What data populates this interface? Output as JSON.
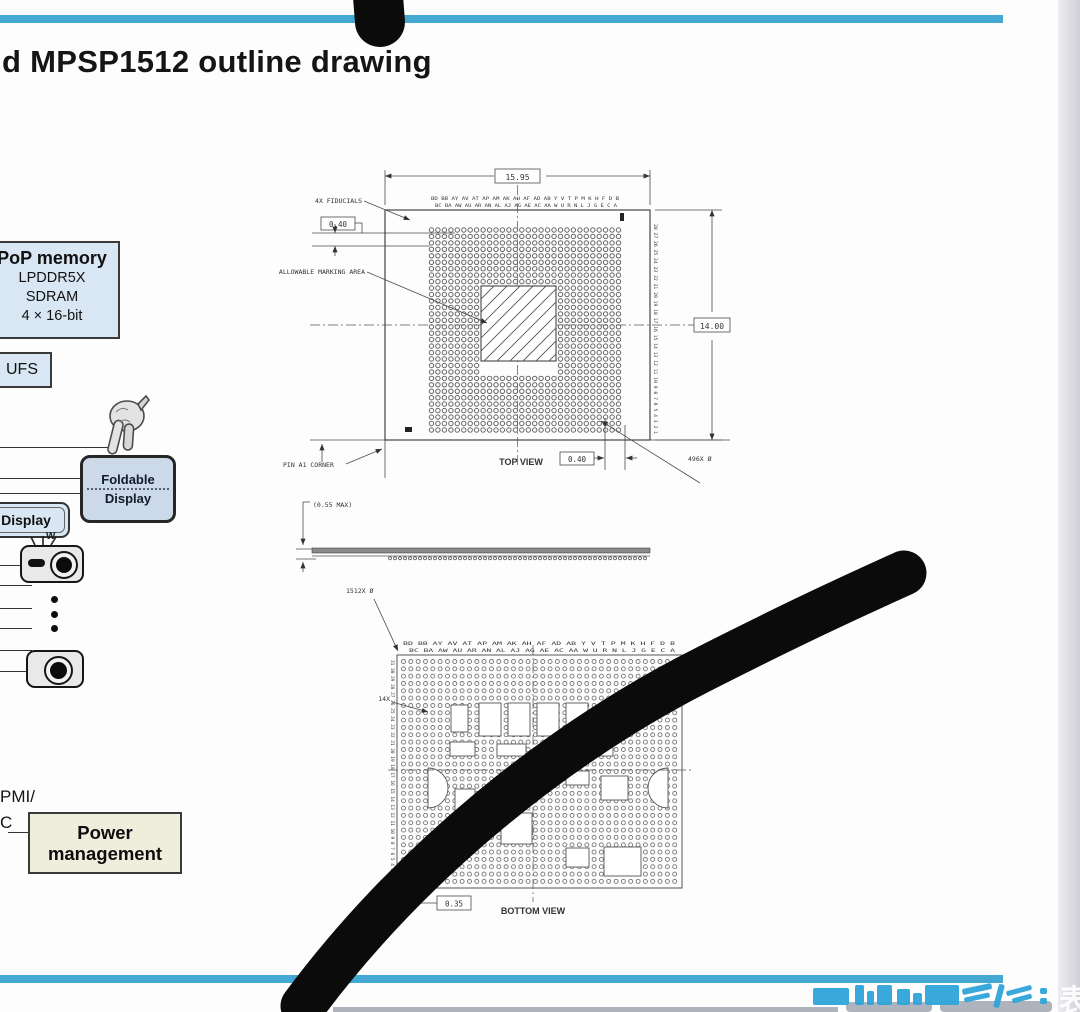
{
  "title": "d MPSP1512 outline drawing",
  "colors": {
    "accent_rule": "#45a8d3",
    "marker_ink": "#0b0b0b"
  },
  "left_panel": {
    "pop_memory_title": "PoP memory",
    "pop_memory_line1": "LPDDR5X",
    "pop_memory_line2": "SDRAM",
    "pop_memory_line3": "4 × 16-bit",
    "ufs_label": "UFS",
    "foldable_line1": "Foldable",
    "foldable_line2": "Display",
    "display_label": "Display",
    "camera_w_label": "W",
    "pmi_line1": "PMI/",
    "pmi_line2": "C",
    "power_line1": "Power",
    "power_line2": "management"
  },
  "top_view": {
    "dim_width": "15.95",
    "dim_height": "14.00",
    "offset_top": "0.40",
    "offset_bottom": "0.40",
    "fiducials": "4X FIDUCIALS",
    "marking": "ALLOWABLE MARKING AREA",
    "pin_a1": "PIN A1 CORNER",
    "label": "TOP VIEW",
    "ball_count": "496X Ø",
    "col_labels_1": "BD BB AY AV AT AP AM AK AH AF AD AB Y V T P M K H F D B",
    "col_labels_2": "BC BA AW AU AR AN AL AJ AG AE AC AA W U R N L J G E C A",
    "row_labels": "28 27 26 25 24 23 22 21 20 19 18 17 16 15 14 13 12 11 10 9 8 7 6 5 4 3 2 1"
  },
  "side_view": {
    "max_height": "(0.55 MAX)"
  },
  "bottom_view": {
    "ball_count": "1512X Ø",
    "fourteen": "14X",
    "pitch": "0.35",
    "label": "BOTTOM VIEW",
    "col_labels_1": "BD BB AY AV AT AP AM AK AH AF AD AB Y V T P M K H F D B",
    "col_labels_2": "BC BA AW AU AR AN AL AJ AG AE AC AA W U R N L J G E C A",
    "row_labels": "31 30 29 28 27 26 25 24 23 22 21 20 19 18 17 16 15 14 13 12 11 10 9 8 7 6 5 4 3 2 1"
  },
  "watermark": {
    "side_char": "表"
  }
}
